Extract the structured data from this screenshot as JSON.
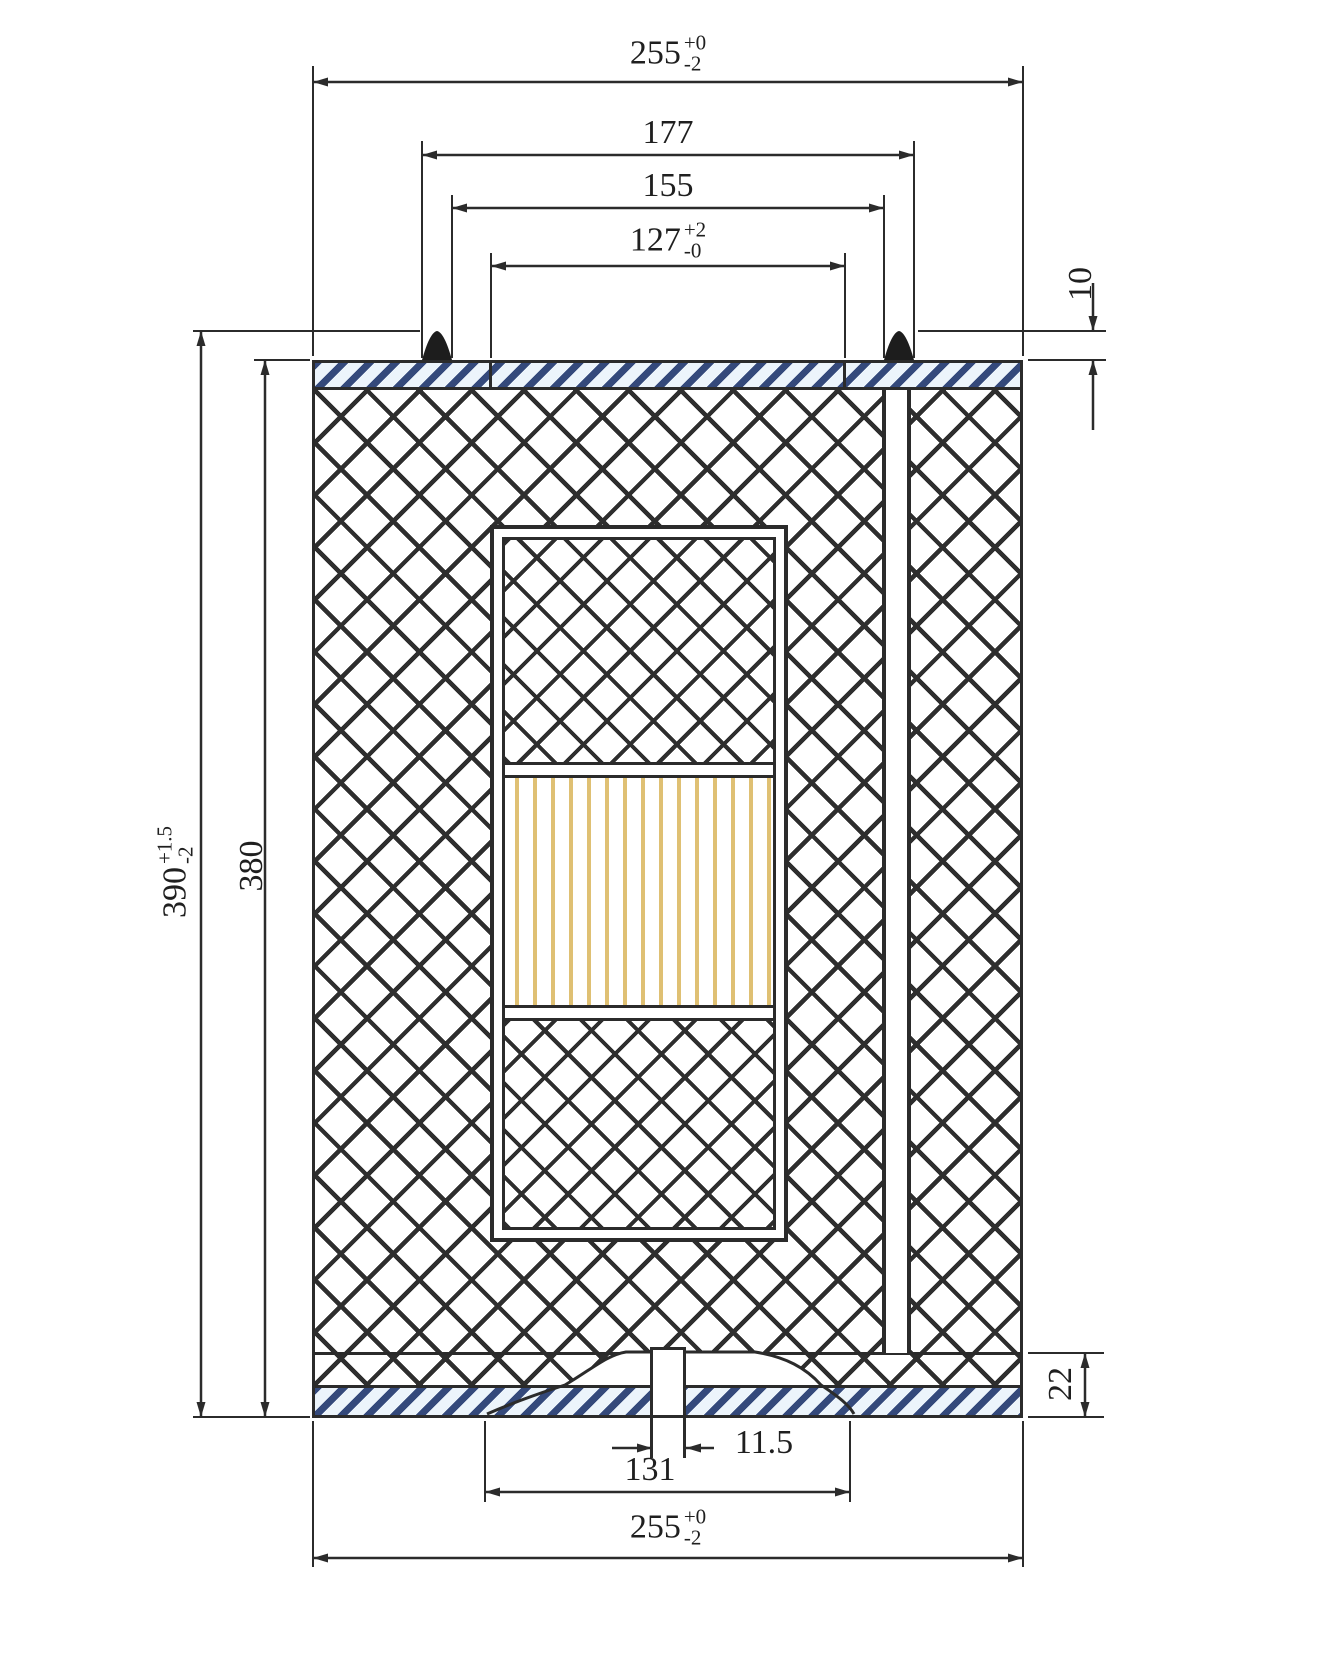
{
  "drawing": {
    "dims": {
      "top_width": {
        "value": "255",
        "tol_plus": "+0",
        "tol_minus": "-2"
      },
      "gasket_outer": {
        "value": "177"
      },
      "media_outer": {
        "value": "155"
      },
      "opening": {
        "value": "127",
        "tol_plus": "+2",
        "tol_minus": "-0"
      },
      "gasket_height": {
        "value": "10"
      },
      "overall_height": {
        "value": "390",
        "tol_plus": "+1.5",
        "tol_minus": "-2"
      },
      "body_height": {
        "value": "380"
      },
      "cap_height": {
        "value": "22"
      },
      "tab_width": {
        "value": "11.5"
      },
      "skirt_width": {
        "value": "131"
      },
      "bottom_width": {
        "value": "255",
        "tol_plus": "+0",
        "tol_minus": "-2"
      }
    },
    "colors": {
      "line": "#2b2b2b",
      "cap_stripe": "#34497b",
      "cap_background": "#ecf4fb",
      "pleat": "#dfc073"
    }
  }
}
